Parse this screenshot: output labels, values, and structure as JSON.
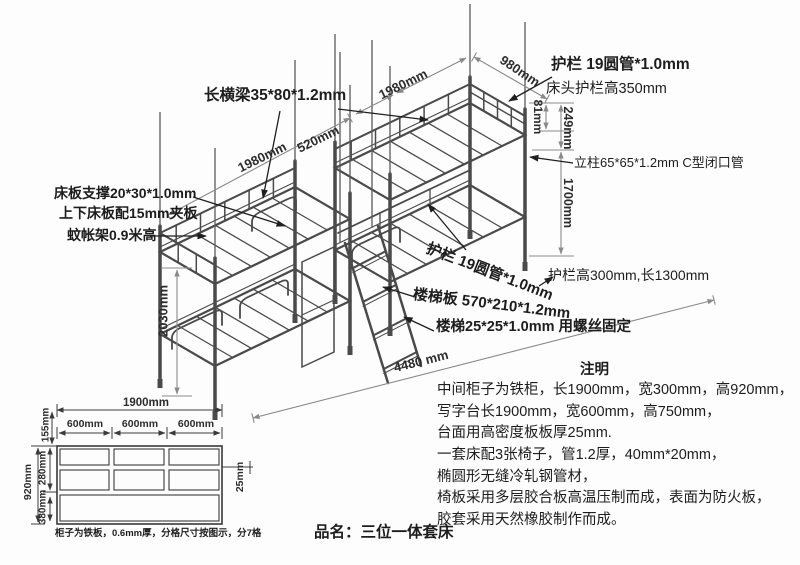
{
  "product": {
    "label": "品名：三位一体套床"
  },
  "callouts": {
    "long_beam": "长横梁35*80*1.2mm",
    "bed_board_support": "床板支撑20*30*1.0mm",
    "bed_board_ply": "上下床板配15mm夹板",
    "mosquito_net_frame": "蚊帐架0.9米高",
    "guardrail_pipe_top": "护栏 19圆管*1.0mm",
    "head_guardrail_height": "床头护栏高350mm",
    "column_spec": "立柱65*65*1.2mm C型闭口管",
    "side_guardrail_size": "护栏高300mm,长1300mm",
    "guardrail_pipe_mid": "护栏 19圆管*1.0mm",
    "ladder_board_spec": "楼梯板 570*210*1.2mm",
    "ladder_spec": "楼梯25*25*1.0mm 用螺丝固定"
  },
  "dimensions": {
    "left_bed_length": "1980mm",
    "middle_gap": "520mm",
    "right_bed_length": "1980mm",
    "bed_width": "980mm",
    "rail_upper_height": "249mm",
    "rail_gap_height": "81mm",
    "column_height": "1700mm",
    "overall_height": "2030mm",
    "overall_length": "4480 mm"
  },
  "notes": {
    "heading": "注明",
    "lines": [
      "中间柜子为铁柜，长1900mm，宽300mm，高920mm，",
      "写字台长1900mm，宽600mm，高750mm，",
      "台面用高密度板板厚25mm.",
      "一套床配3张椅子，管1.2厚，40mm*20mm，",
      "椭圆形无缝冷轧钢管材，",
      "椅板采用多层胶合板高温压制而成，表面为防火板，",
      "胶套采用天然橡胶制作而成。"
    ]
  },
  "cabinet_detail": {
    "overall_width": "1900mm",
    "cell_widths": [
      "600mm",
      "600mm",
      "600mm"
    ],
    "overall_height": "920mm",
    "top_row_height": "155mm",
    "middle_row_height": "280mm",
    "bottom_row_height": "380mm",
    "shelf_thickness": "25mm",
    "caption": "柜子为铁板，0.6mm厚，分格尺寸按图示，分7格"
  },
  "colors": {
    "background": "#fdfdfd",
    "frame_line": "#4a4a4a",
    "dimension_line": "#8a8a8a",
    "text": "#1d1d1d"
  }
}
